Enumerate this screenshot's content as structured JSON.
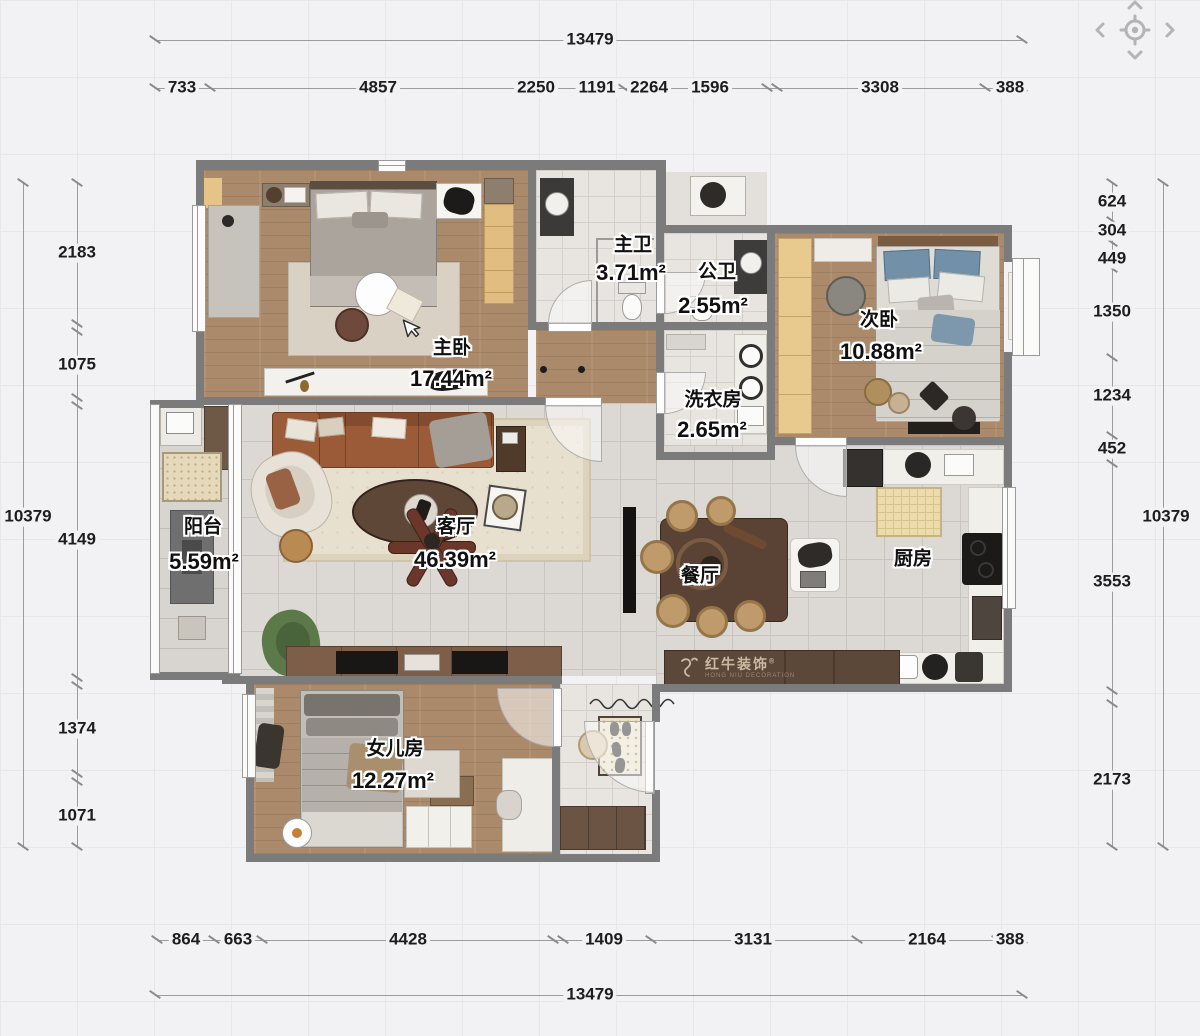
{
  "dimensions": {
    "top_total": "13479",
    "top_segments": [
      "733",
      "4857",
      "2250",
      "1191",
      "2264",
      "1596",
      "3308",
      "388"
    ],
    "bottom_segments": [
      "864",
      "663",
      "4428",
      "1409",
      "3131",
      "2164",
      "388"
    ],
    "bottom_total": "13479",
    "left_segments": [
      "2183",
      "1075",
      "4149",
      "1374",
      "1071"
    ],
    "left_total": "10379",
    "right_segments": [
      "624",
      "304",
      "449",
      "1350",
      "1234",
      "452",
      "3553",
      "2173"
    ],
    "right_total": "10379"
  },
  "rooms": [
    {
      "name": "主卧",
      "area": "17.44m²"
    },
    {
      "name": "主卫",
      "area": "3.71m²"
    },
    {
      "name": "公卫",
      "area": "2.55m²"
    },
    {
      "name": "洗衣房",
      "area": "2.65m²"
    },
    {
      "name": "次卧",
      "area": "10.88m²"
    },
    {
      "name": "阳台",
      "area": "5.59m²"
    },
    {
      "name": "客厅",
      "area": "46.39m²"
    },
    {
      "name": "餐厅",
      "area": ""
    },
    {
      "name": "厨房",
      "area": ""
    },
    {
      "name": "女儿房",
      "area": "12.27m²"
    }
  ],
  "watermark": {
    "brand": "红牛装饰",
    "subtitle": "HONG NIU DECORATION",
    "registered": "®"
  },
  "colors": {
    "wall": "#7b7b7b",
    "wood": "#ab8a6b",
    "sofa": "#9c5b38",
    "bed_blue": "#7291a8",
    "dim_text": "#1d1d1d"
  }
}
